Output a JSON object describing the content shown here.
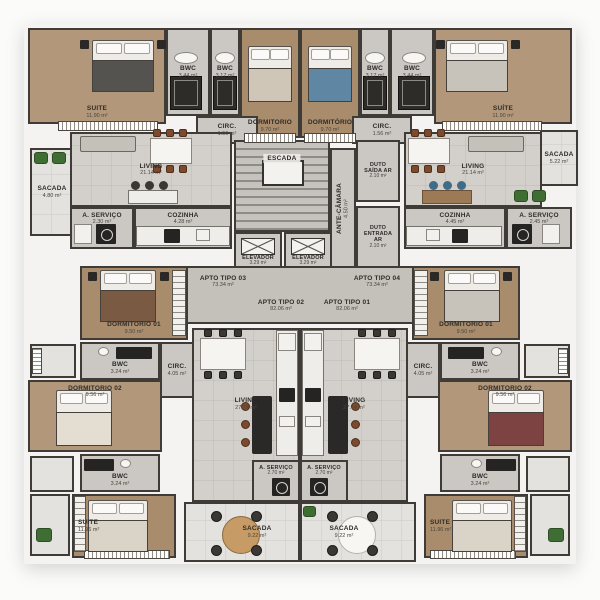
{
  "palette": {
    "wall": "#3f3c38",
    "wood_floor": "#b3977a",
    "tile_floor": "#cbc8c3",
    "living_floor": "#d3d0cb",
    "balcony_floor": "#e4e2de",
    "plant_green": "#3f6d33"
  },
  "rooms": {
    "tl_suite": {
      "label": "SUITE",
      "area": "11.90 m²"
    },
    "tl_bwc_a": {
      "label": "BWC",
      "area": "3.44 m²"
    },
    "tl_bwc_b": {
      "label": "BWC",
      "area": "3.17 m²"
    },
    "tl_dorm": {
      "label": "DORMITORIO",
      "area": "9.70 m²"
    },
    "tl_circ": {
      "label": "CIRC.",
      "area": "1.56 m²"
    },
    "tl_living": {
      "label": "LIVING",
      "area": "21.14 m²"
    },
    "tl_sacada": {
      "label": "SACADA",
      "area": "4.80 m²"
    },
    "tl_servico": {
      "label": "A. SERVIÇO",
      "area": "2.30 m²"
    },
    "tl_cozinha": {
      "label": "COZINHA",
      "area": "4.28 m²"
    },
    "tr_dorm": {
      "label": "DORMITÓRIO",
      "area": "9.70 m²"
    },
    "tr_bwc_a": {
      "label": "BWC",
      "area": "3.17 m²"
    },
    "tr_bwc_b": {
      "label": "BWC",
      "area": "3.44 m²"
    },
    "tr_suite": {
      "label": "SUÍTE",
      "area": "11.90 m²"
    },
    "tr_circ": {
      "label": "CIRC.",
      "area": "1.56 m²"
    },
    "tr_living": {
      "label": "LIVING",
      "area": "21.14 m²"
    },
    "tr_sacada": {
      "label": "SACADA",
      "area": "5.22 m²"
    },
    "tr_cozinha": {
      "label": "COZINHA",
      "area": "4.45 m²"
    },
    "tr_servico": {
      "label": "A. SERVIÇO",
      "area": "2.45 m²"
    },
    "escada": {
      "label": "ESCADA"
    },
    "ante_camara": {
      "label": "ANTE-CÂMARA",
      "area": "4.50 m²"
    },
    "duto_saida": {
      "label": "DUTO SAÍDA AR",
      "area": "2.10 m²"
    },
    "duto_entrada": {
      "label": "DUTO ENTRADA AR",
      "area": "2.10 m²"
    },
    "elevador_l": {
      "label": "ELEVADOR",
      "area": "3.29 m²"
    },
    "elevador_r": {
      "label": "ELEVADOR",
      "area": "3.29 m²"
    },
    "bl_dorm1": {
      "label": "DORMITORIO 01",
      "area": "9.50 m²"
    },
    "bl_bwc_a": {
      "label": "BWC",
      "area": "3.24 m²"
    },
    "bl_circ": {
      "label": "CIRC.",
      "area": "4.05 m²"
    },
    "bl_dorm2": {
      "label": "DORMITORIO 02",
      "area": "9.56 m²"
    },
    "bl_bwc_b": {
      "label": "BWC",
      "area": "3.24 m²"
    },
    "bl_suite": {
      "label": "SUITE",
      "area": "11.96 m²"
    },
    "bl_living": {
      "label": "LIVING",
      "area": "27.74 m²"
    },
    "bl_servico": {
      "label": "A. SERVIÇO",
      "area": "2.70 m²"
    },
    "bl_sacada": {
      "label": "SACADA",
      "area": "9.22 m²"
    },
    "br_dorm1": {
      "label": "DORMITORIO 01",
      "area": "9.50 m²"
    },
    "br_bwc_a": {
      "label": "BWC",
      "area": "3.24 m²"
    },
    "br_circ": {
      "label": "CIRC.",
      "area": "4.05 m²"
    },
    "br_dorm2": {
      "label": "DORMITORIO 02",
      "area": "9.56 m²"
    },
    "br_bwc_b": {
      "label": "BWC",
      "area": "3.24 m²"
    },
    "br_suite": {
      "label": "SUITE",
      "area": "11.96 m²"
    },
    "br_living": {
      "label": "LIVING",
      "area": "27.74 m²"
    },
    "br_servico": {
      "label": "A. SERVIÇO",
      "area": "2.70 m²"
    },
    "br_sacada": {
      "label": "SACADA",
      "area": "9.22 m²"
    }
  },
  "halls": {
    "tipo03": {
      "label": "APTO TIPO 03",
      "area": "73.34 m²"
    },
    "tipo04": {
      "label": "APTO TIPO 04",
      "area": "73.34 m²"
    },
    "tipo02": {
      "label": "APTO TIPO 02",
      "area": "82.06 m²"
    },
    "tipo01": {
      "label": "APTO TIPO 01",
      "area": "82.06 m²"
    }
  }
}
